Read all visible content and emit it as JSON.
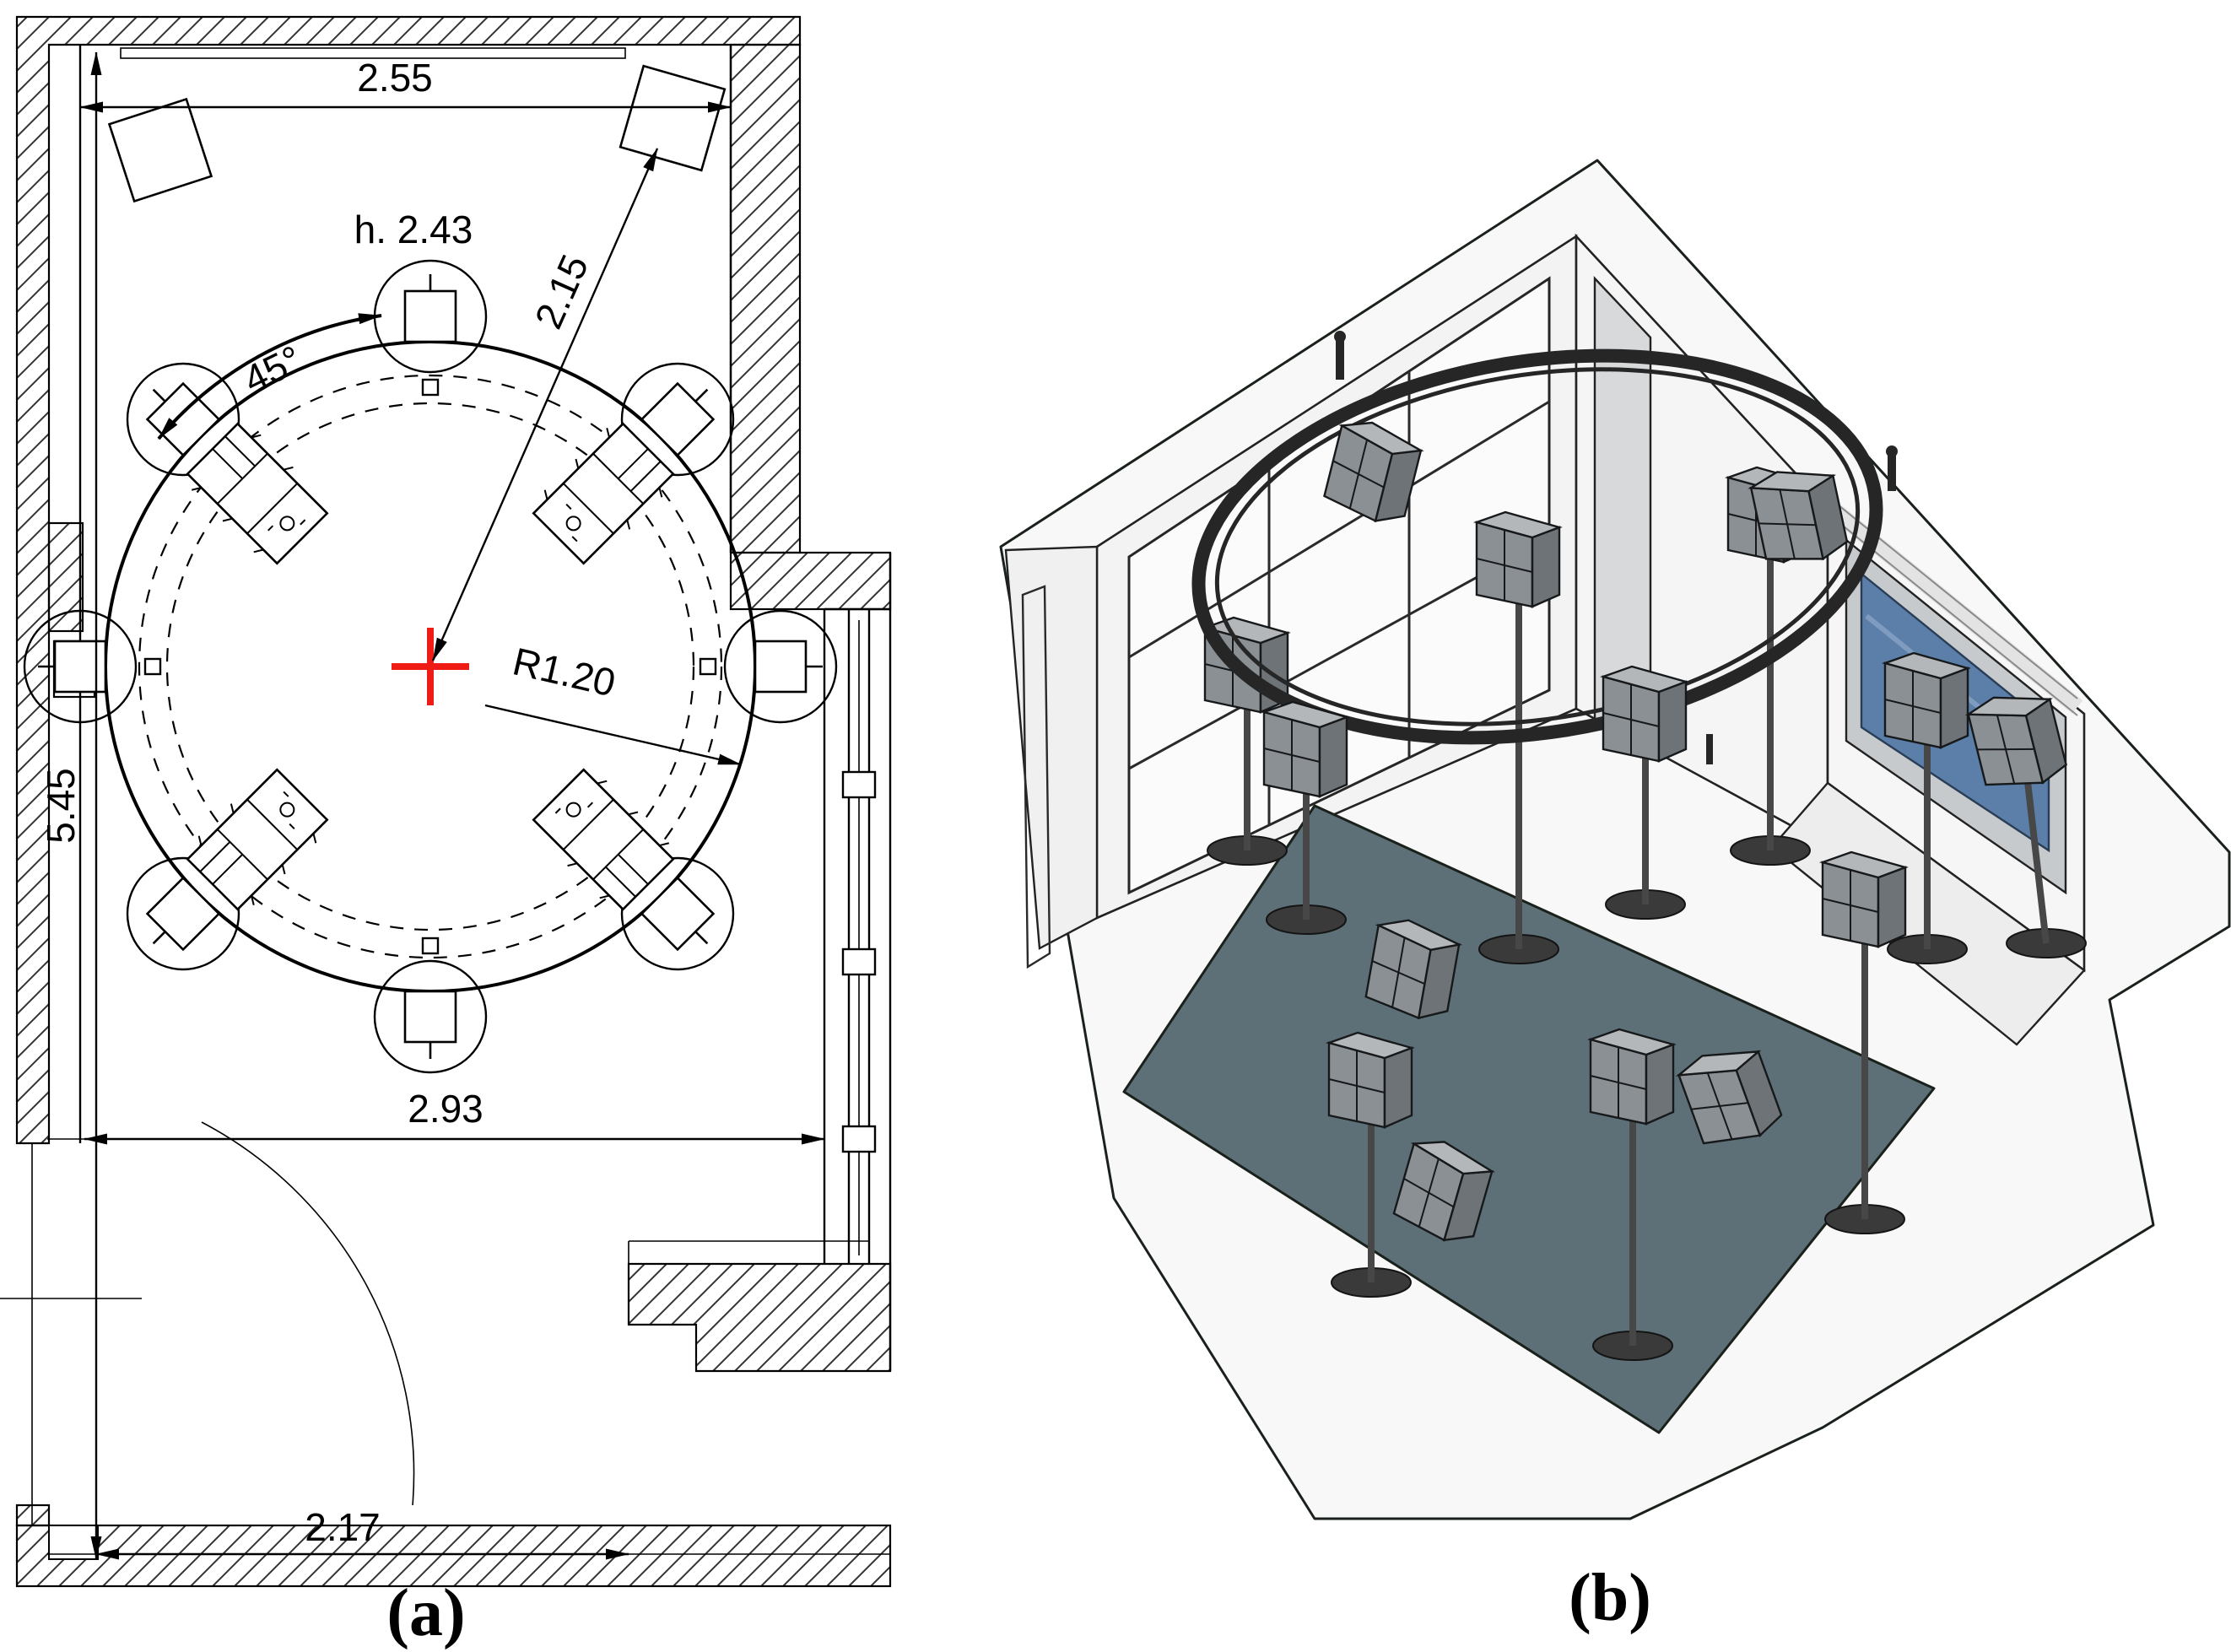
{
  "figure": {
    "panel_a": {
      "label": "(a)",
      "dimensions": {
        "top_width": "2.55",
        "ceiling_height": "h. 2.43",
        "speaker_spacing_angle": "45°",
        "corner_speaker_distance": "2.15",
        "array_radius": "R1.20",
        "room_depth": "5.45",
        "mid_width": "2.93",
        "bottom_width": "2.17"
      }
    },
    "panel_b": {
      "label": "(b)"
    },
    "colors": {
      "center_cross": "#ee1c15",
      "floor": "#5d7078",
      "window_glass": "#5b7fa8",
      "ring": "#262626"
    }
  }
}
